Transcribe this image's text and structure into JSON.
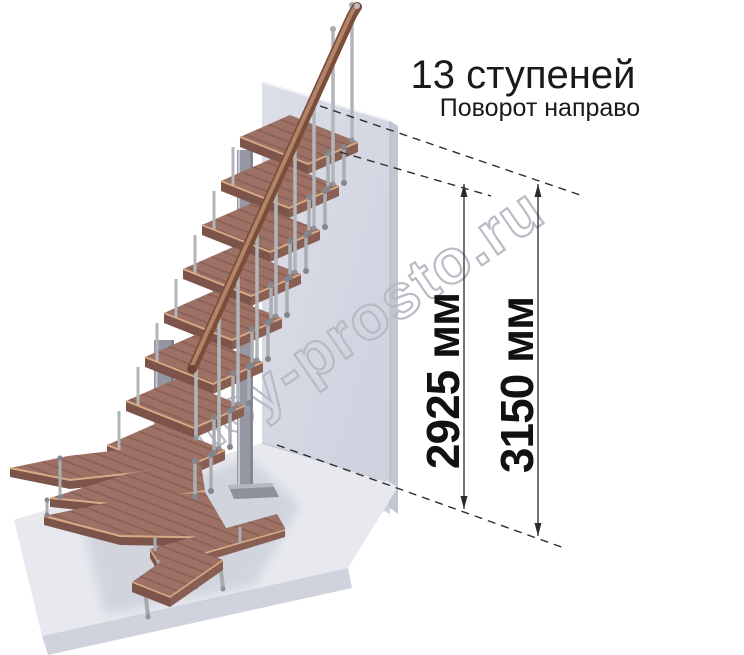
{
  "title": "13 ступеней",
  "subtitle": "Поворот направо",
  "watermark": "lestnicy-prosto.ru",
  "dimensions": {
    "inner": "2925 мм",
    "outer": "3150 мм"
  },
  "stairs": {
    "step_count": 13
  },
  "colors": {
    "wood": "#9d7165",
    "wood_edge_highlight": "#d8ab87",
    "metal": "#b2b5ba",
    "wall": "#d5d7e2",
    "floor": "#e7e9ef",
    "text": "#1a1a1a",
    "watermark_outline": "#b6b9c2"
  }
}
